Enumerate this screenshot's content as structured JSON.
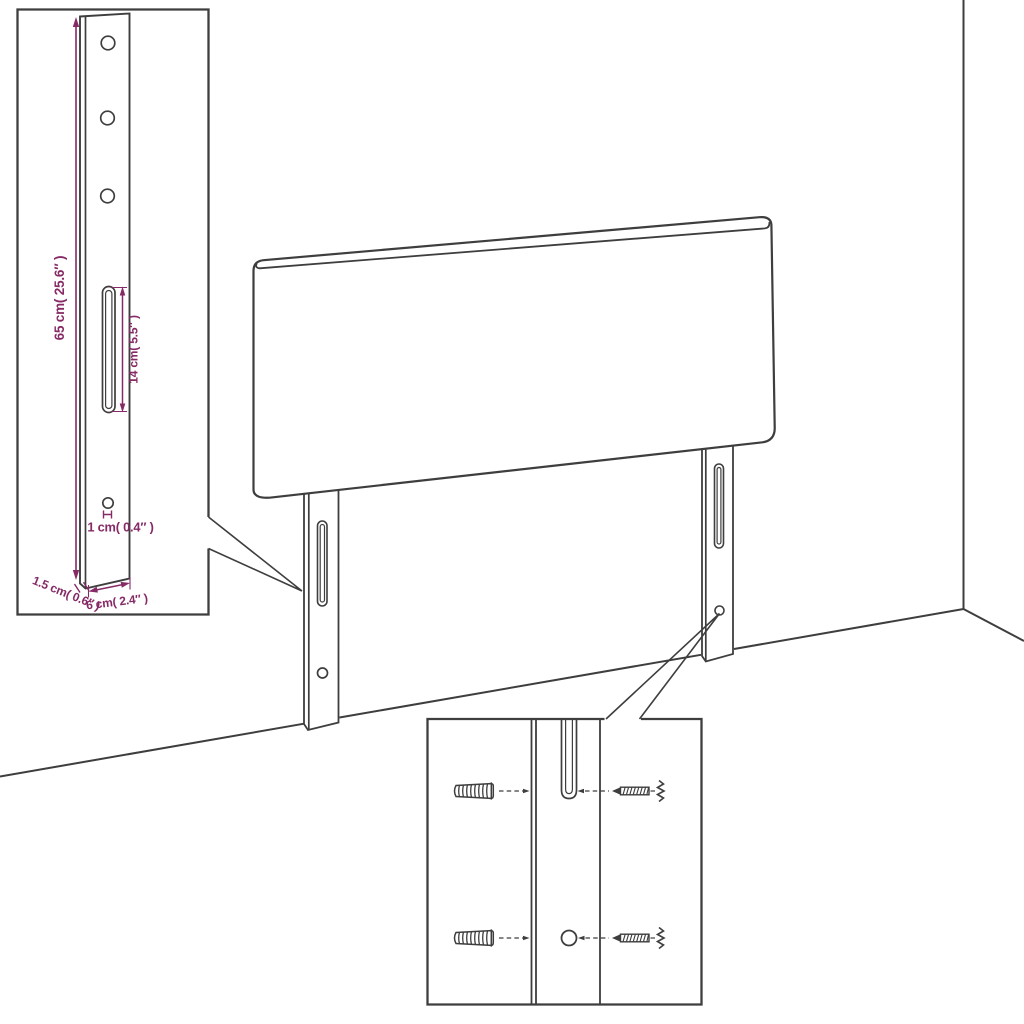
{
  "diagram": {
    "colors": {
      "background": "#ffffff",
      "line_art": "#3e3e3e",
      "dimension_text": "#862a66"
    },
    "leg_detail_inset": {
      "height_label": "65 cm( 25.6″ )",
      "slot_label": "14 cm( 5.5″ )",
      "hole_label": "1 cm( 0.4″ )",
      "thickness_label": "1.5 cm( 0.6″ )",
      "width_label": "6 cm( 2.4″ )"
    },
    "mounting_detail_inset": {
      "wall_plug_count": 2,
      "screw_count": 2
    }
  }
}
